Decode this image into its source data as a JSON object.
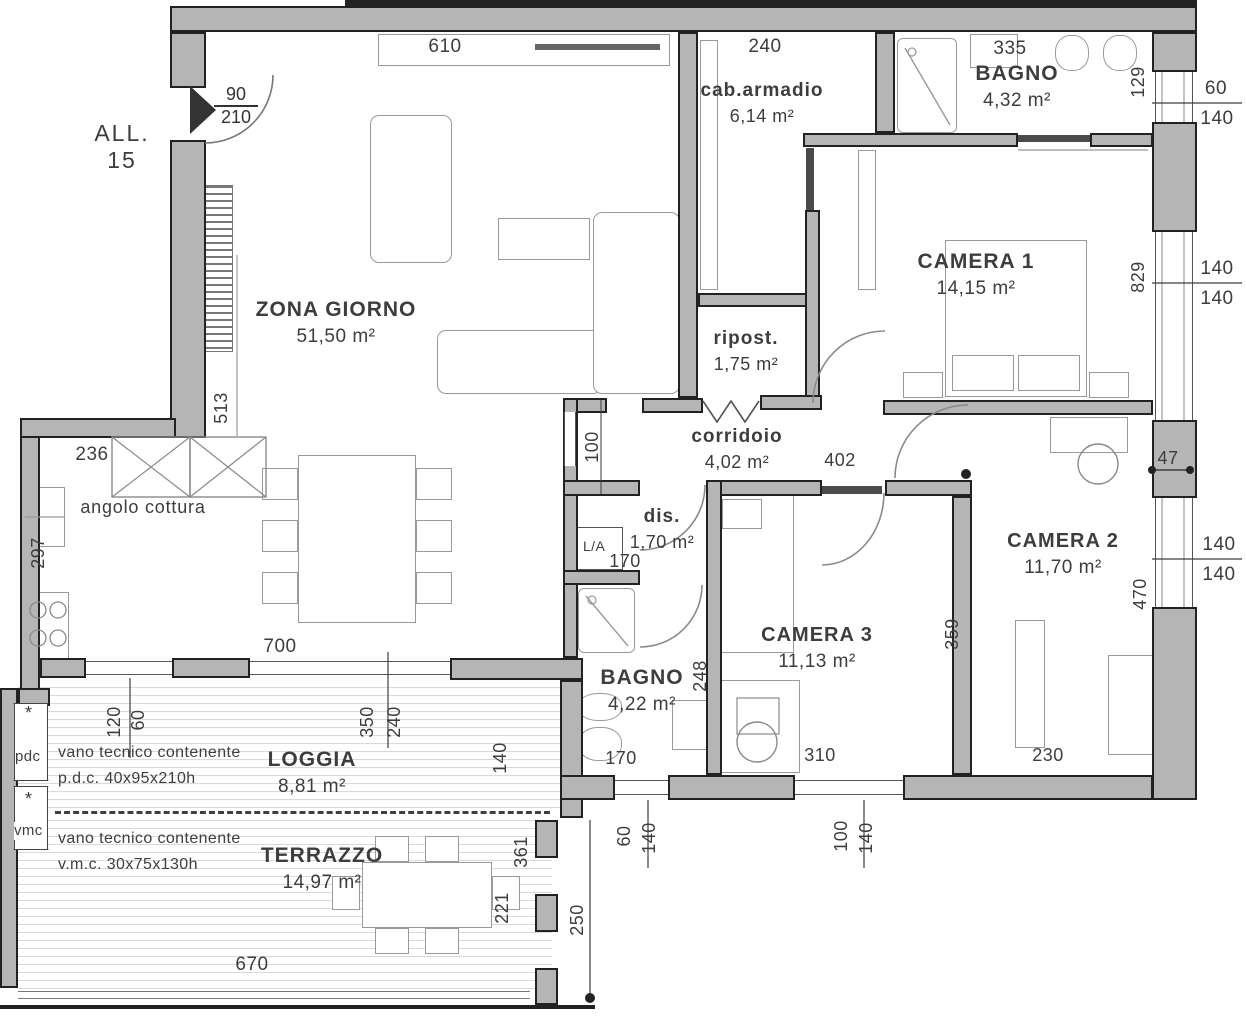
{
  "plan": {
    "sheet_label": "ALL. 15",
    "entrance_door": {
      "width": "90",
      "height": "210"
    }
  },
  "rooms": {
    "zona_giorno": {
      "name": "ZONA GIORNO",
      "area": "51,50 m²"
    },
    "angolo_cottura": {
      "name": "angolo cottura"
    },
    "cab_armadio": {
      "name": "cab.armadio",
      "area": "6,14 m²"
    },
    "bagno1": {
      "name": "BAGNO",
      "area": "4,32 m²"
    },
    "camera1": {
      "name": "CAMERA 1",
      "area": "14,15 m²"
    },
    "ripost": {
      "name": "ripost.",
      "area": "1,75 m²"
    },
    "corridoio": {
      "name": "corridoio",
      "area": "4,02 m²"
    },
    "dis": {
      "name": "dis.",
      "area": "1,70 m²"
    },
    "bagno2": {
      "name": "BAGNO",
      "area": "4,22 m²"
    },
    "camera3": {
      "name": "CAMERA 3",
      "area": "11,13 m²"
    },
    "camera2": {
      "name": "CAMERA 2",
      "area": "11,70 m²"
    },
    "loggia": {
      "name": "LOGGIA",
      "area": "8,81 m²"
    },
    "terrazzo": {
      "name": "TERRAZZO",
      "area": "14,97 m²"
    }
  },
  "annotations": {
    "vano1_line1": "vano tecnico contenente",
    "vano1_line2": "p.d.c. 40x95x210h",
    "vano2_line1": "vano tecnico contenente",
    "vano2_line2": "v.m.c. 30x75x130h",
    "pdc": "pdc",
    "vmc": "vmc",
    "la_box": "L/A",
    "asterisk": "*"
  },
  "dimensions": {
    "h610": "610",
    "h240": "240",
    "h335": "335",
    "h700": "700",
    "h402": "402",
    "h236": "236",
    "h170_dis": "170",
    "h170_bagno": "170",
    "h310": "310",
    "h230": "230",
    "h670": "670",
    "h47": "47",
    "v129": "129",
    "v829": "829",
    "v513": "513",
    "v297": "297",
    "v100": "100",
    "v470": "470",
    "v359": "359",
    "v248": "248",
    "v120": "120",
    "v60_loggia": "60",
    "v350": "350",
    "v240": "240",
    "v140_loggia": "140",
    "v361": "361",
    "v221": "221",
    "v250": "250",
    "v60_bagno": "60",
    "v140_bagno": "140",
    "v100_cam3": "100",
    "v140_cam3": "140",
    "r60_top": "60",
    "r140_top": "140",
    "r140_c1a": "140",
    "r140_c1b": "140",
    "r140_c2a": "140",
    "r140_c2b": "140"
  },
  "colors": {
    "wall_fill": "#b5b5b5",
    "wall_outline": "#222222",
    "hatch_line": "#d9d9d9",
    "text": "#3d3d3d"
  }
}
